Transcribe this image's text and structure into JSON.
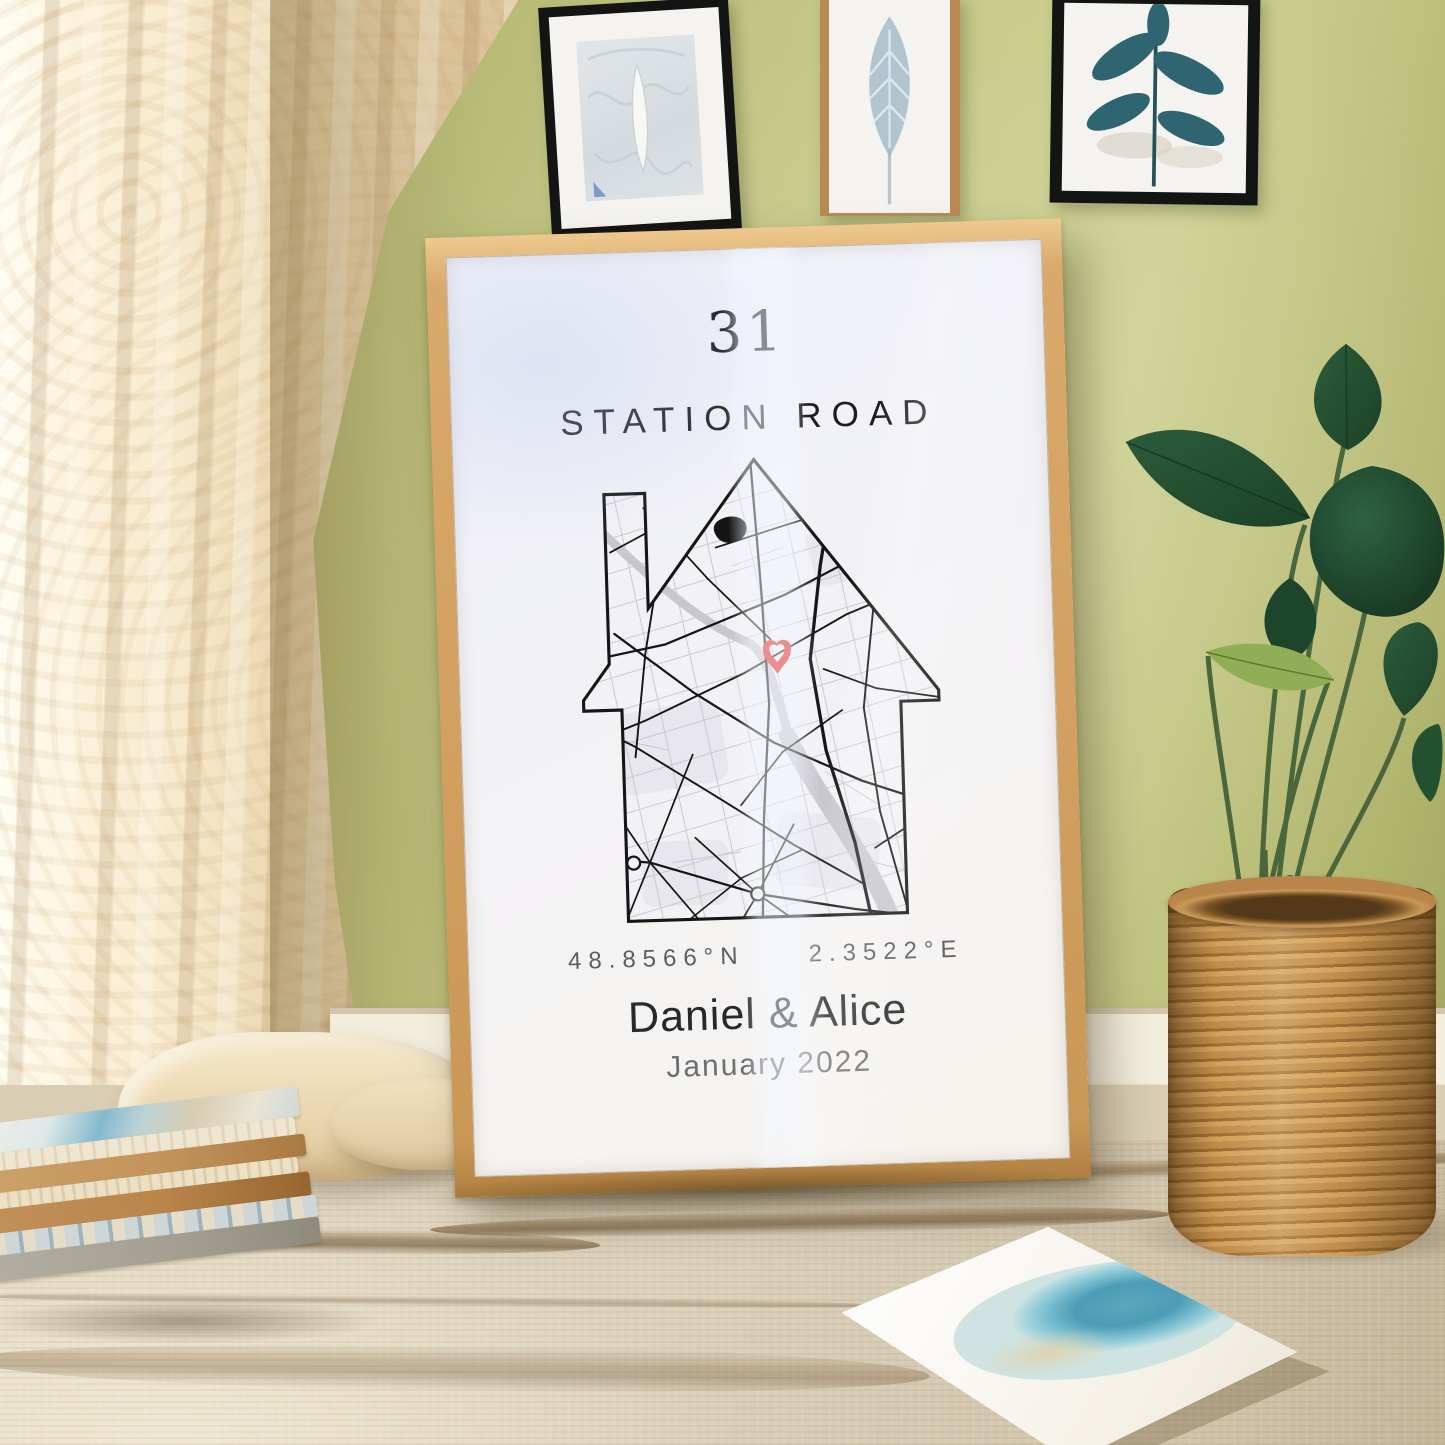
{
  "poster": {
    "house_number": "31",
    "street_name": "STATION ROAD",
    "latitude": "48.8566°N",
    "longitude": "2.3522°E",
    "names": "Daniel & Alice",
    "date": "January 2022"
  },
  "colors": {
    "wall_green": "#b9bc77",
    "frame_wood": "#d9a96b",
    "poster_white": "#f5f3f2",
    "map_ink": "#161616",
    "river_gray": "#c7c7cc",
    "pin_red": "#e0251d",
    "curtain_cream": "#f6e9cd",
    "rug_beige": "#ddd2bc",
    "basket_tan": "#c08c49",
    "leaf_green": "#24513a",
    "text_dark": "#28282b",
    "text_gray": "#5d5d60"
  },
  "scene": {
    "wall_art": [
      {
        "name": "abstract botanical sketch print"
      },
      {
        "name": "blue feather print"
      },
      {
        "name": "teal leaf branch print"
      }
    ],
    "decor": [
      "cream patterned curtain",
      "green painted wall",
      "wooden poster frame leaning on floor",
      "stack of sketchbooks",
      "blue circle watercolor canvas",
      "houseplant in wicker basket",
      "beige woven rug"
    ],
    "map_pin": "heart-pin-icon"
  }
}
